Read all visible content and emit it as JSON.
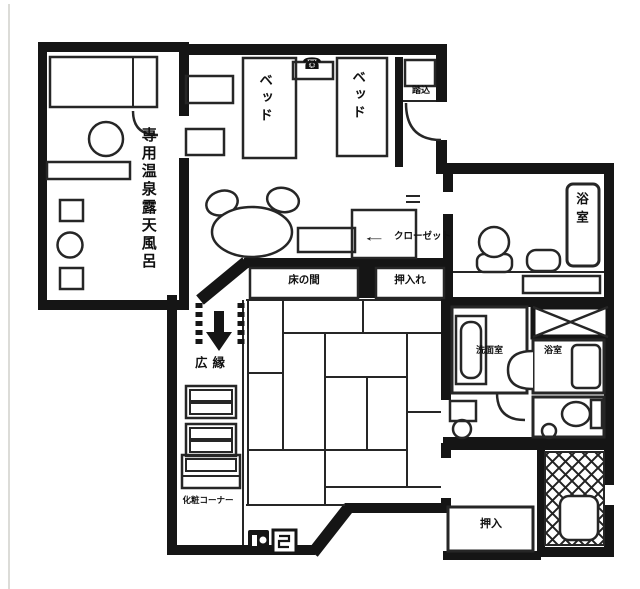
{
  "title": "Japanese ryokan guest-room floor plan",
  "labels": {
    "private_open_air_bath": "専用温泉露天風呂",
    "bed_left": "ベッド",
    "bed_right": "ベッド",
    "entrance_step": "踏込",
    "main_bath": "浴室",
    "closet_arrow": "←",
    "closet": "クローゼット",
    "tokonoma": "床の間",
    "upper_closet": "押入れ",
    "washroom": "洗面室",
    "unit_bath": "浴室",
    "veranda": "広縁",
    "vanity_corner": "化粧コーナー",
    "lower_closet": "押入",
    "phone_icon": "☎"
  },
  "colors": {
    "wall": "#151515",
    "line": "#262626",
    "background": "#ffffff",
    "page": "#f6f6f3"
  }
}
